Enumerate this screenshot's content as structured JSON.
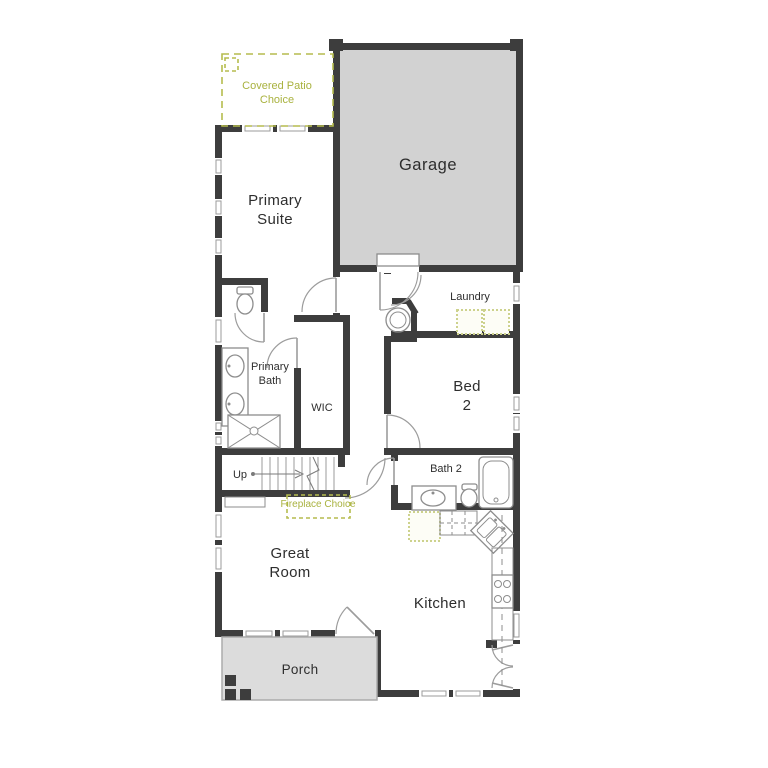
{
  "palette": {
    "wall": "#3d3d3d",
    "garage_fill": "#d2d2d2",
    "porch_fill": "#dcdcdc",
    "option_green": "#a9b23f",
    "fixture_gray": "#8d8d8d",
    "label_color": "#2e2e2e"
  },
  "rooms": {
    "garage": {
      "label": "Garage"
    },
    "primary_suite": {
      "line1": "Primary",
      "line2": "Suite"
    },
    "laundry": {
      "label": "Laundry"
    },
    "primary_bath": {
      "line1": "Primary",
      "line2": "Bath"
    },
    "wic": {
      "label": "WIC"
    },
    "bed_2": {
      "line1": "Bed",
      "line2": "2"
    },
    "bath_2": {
      "label": "Bath 2"
    },
    "great_room": {
      "line1": "Great",
      "line2": "Room"
    },
    "kitchen": {
      "label": "Kitchen"
    },
    "porch": {
      "label": "Porch"
    }
  },
  "options": {
    "covered_patio": {
      "line1": "Covered Patio",
      "line2": "Choice"
    },
    "fireplace": {
      "label": "Fireplace Choice"
    }
  },
  "stairs": {
    "up_label": "Up"
  }
}
